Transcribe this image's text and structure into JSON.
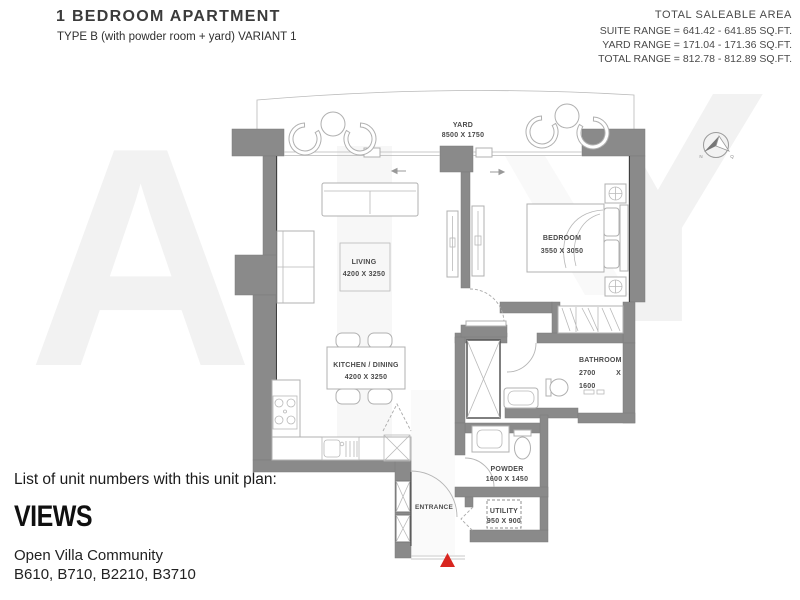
{
  "header": {
    "title": "1 BEDROOM APARTMENT",
    "subtitle": "TYPE B (with powder room + yard) VARIANT 1",
    "saleable_area": {
      "heading": "TOTAL SALEABLE AREA",
      "suite_range": "SUITE RANGE = 641.42 - 641.85 SQ.FT.",
      "yard_range": "YARD RANGE = 171.04 - 171.36 SQ.FT.",
      "total_range": "TOTAL RANGE = 812.78 - 812.89 SQ.FT."
    }
  },
  "plan": {
    "labels": {
      "yard": {
        "name": "YARD",
        "dims": "8500 X 1750"
      },
      "living": {
        "name": "LIVING",
        "dims": "4200 X 3250"
      },
      "bedroom": {
        "name": "BEDROOM",
        "dims": "3550 X 3050"
      },
      "kitchen": {
        "name": "KITCHEN / DINING",
        "dims": "4200 X 3250"
      },
      "bathroom": {
        "name": "BATHROOM",
        "width": "2700",
        "by": "X",
        "height": "1600"
      },
      "powder": {
        "name": "POWDER",
        "dims": "1600 X 1450"
      },
      "utility": {
        "name": "UTILITY",
        "dims": "950 X 900"
      },
      "entrance": {
        "name": "ENTRANCE"
      }
    },
    "compass": {
      "north_label": "N",
      "qibla_label": "Q"
    }
  },
  "footer": {
    "list_heading": "List of unit numbers with this unit plan:",
    "logo": "VIEWS",
    "community": "Open Villa Community",
    "units": "B610, B710, B2210, B3710"
  },
  "watermark": {
    "letter_a": "A",
    "letter_y": "Y"
  },
  "colors": {
    "wall": "#8a8a8a",
    "entrance_marker": "#d8251f",
    "plan_line": "#b0b0b0",
    "label_text": "#4a4a4a",
    "watermark": "#f2f2f2"
  }
}
